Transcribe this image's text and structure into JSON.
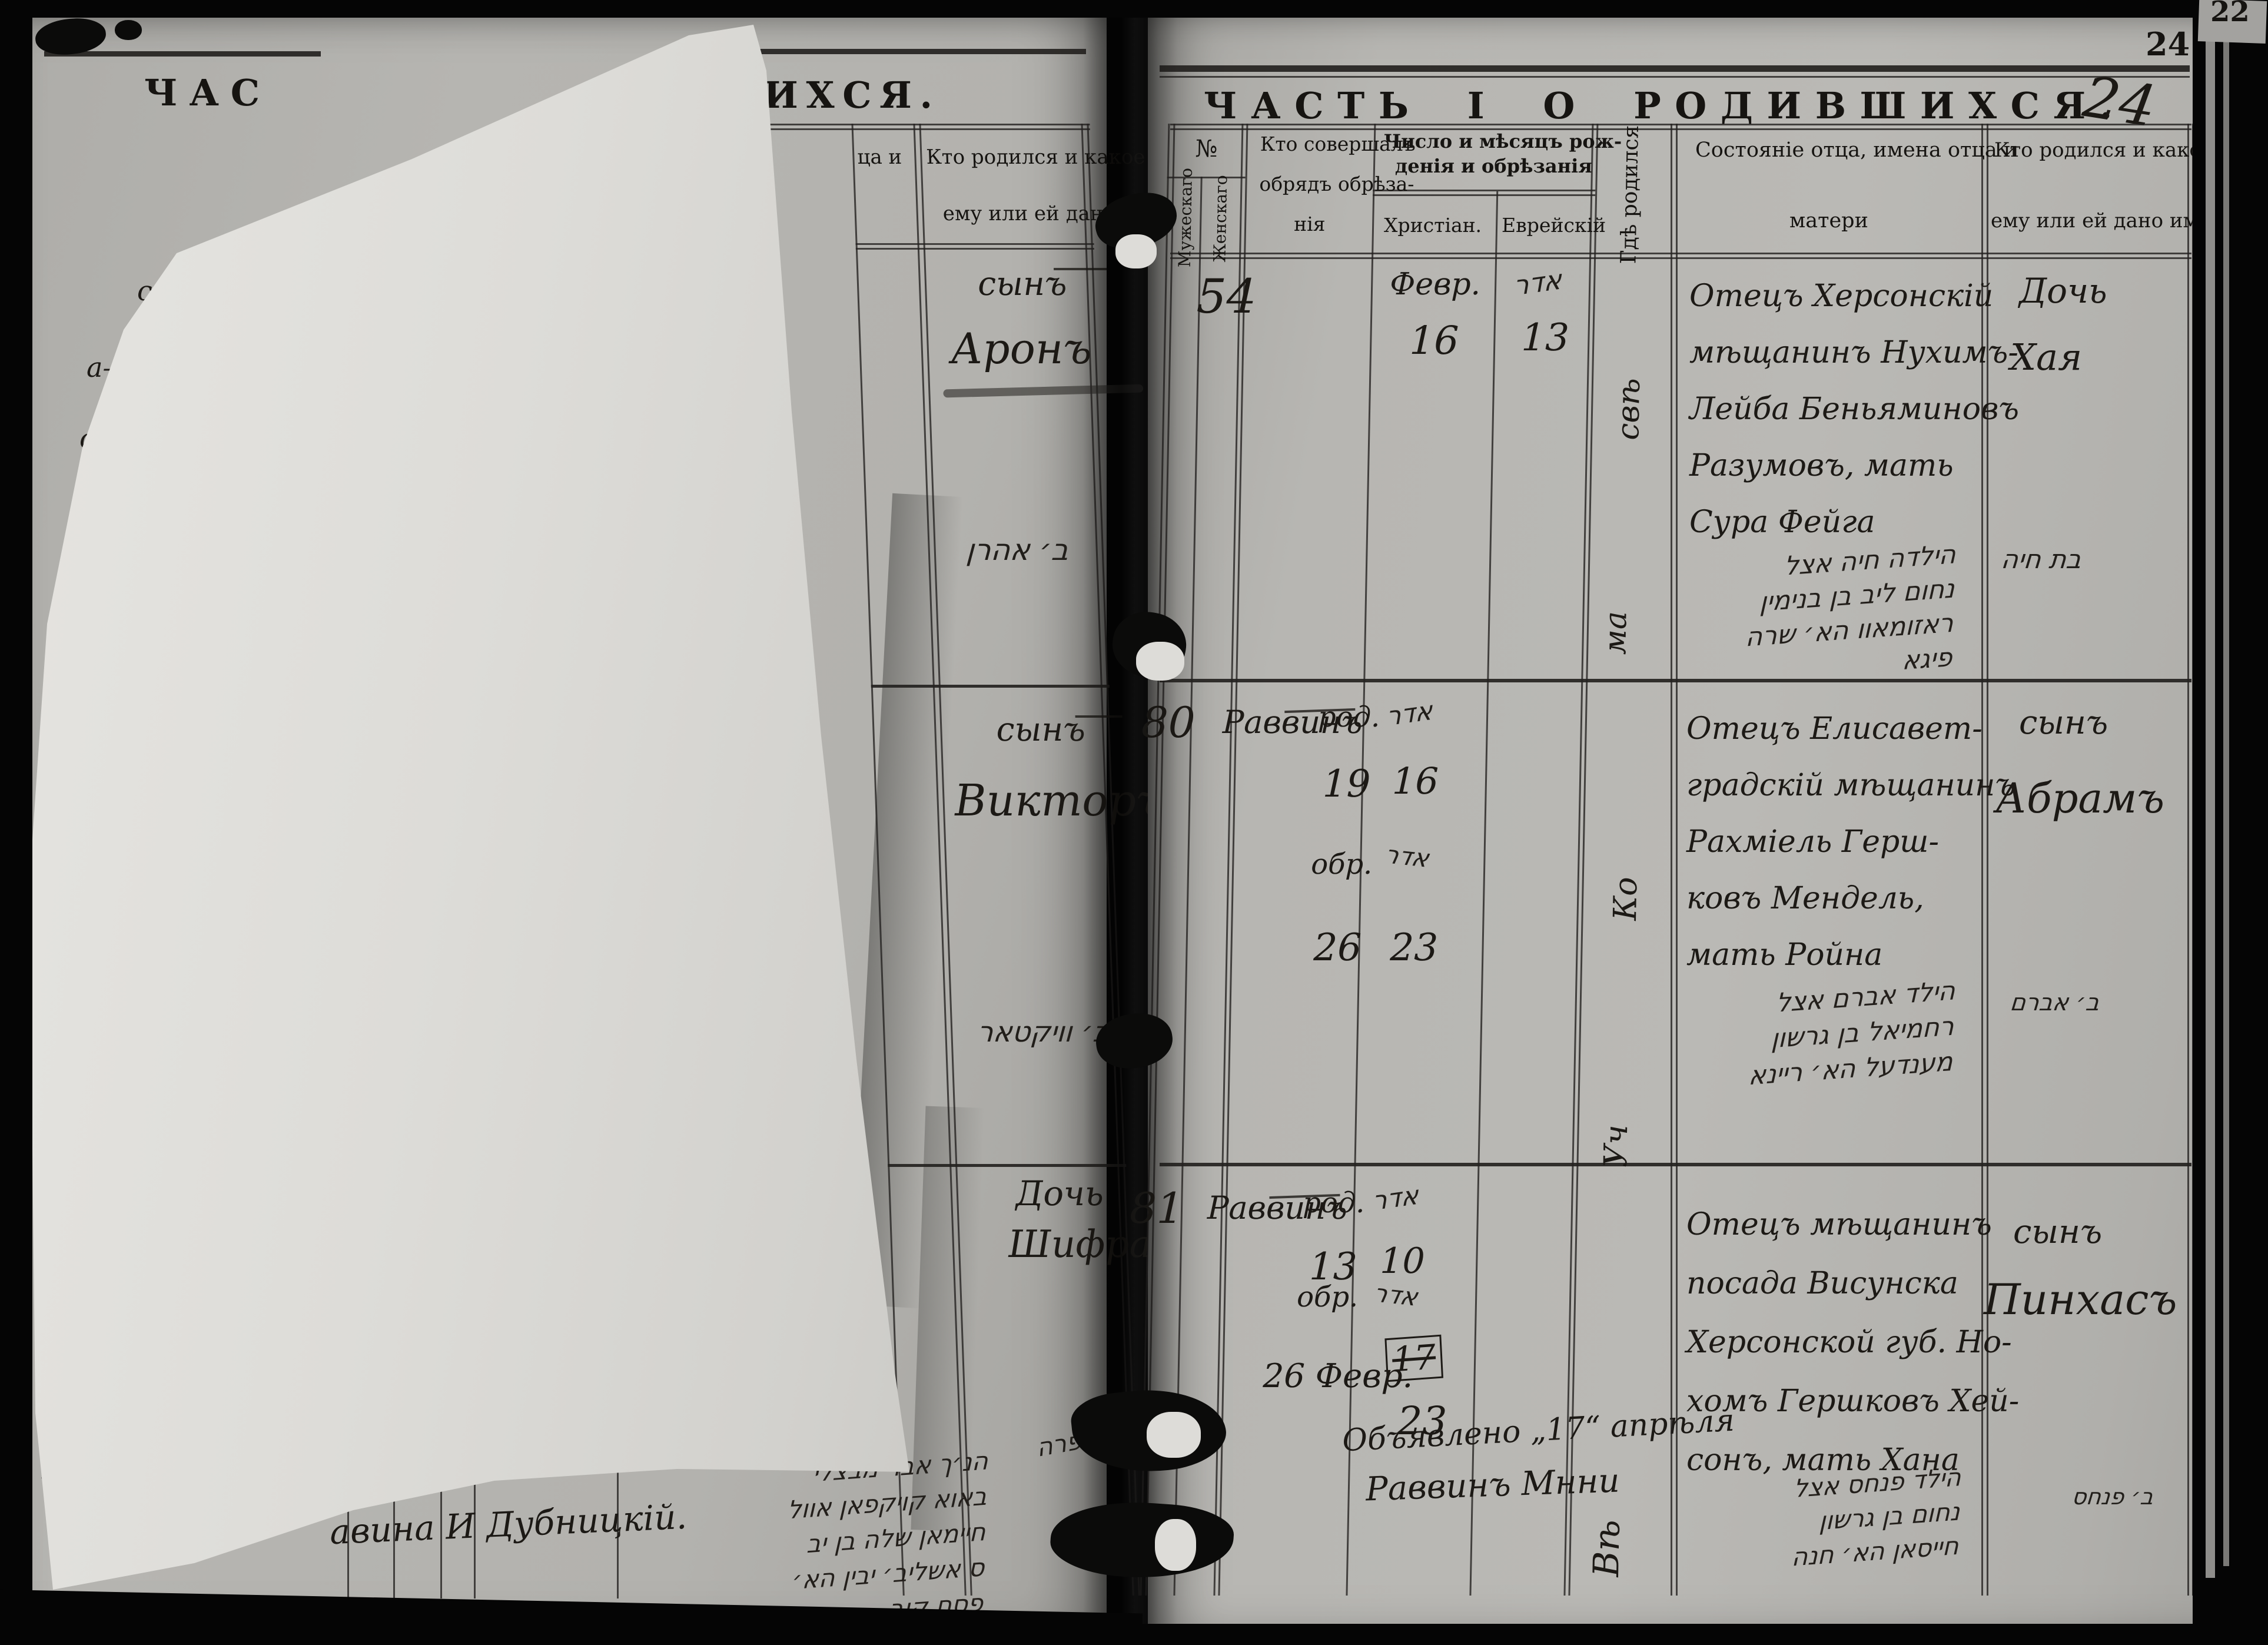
{
  "scan": {
    "corner_fragment": "22",
    "printed_page_number": "24",
    "handwritten_page_number": "24"
  },
  "left_page": {
    "title_fragment_left": "ЧАС",
    "title_fragment_right": "ШИХСЯ.",
    "header": {
      "father_col_fragment": "ца и",
      "name_col_line1": "Кто родился и какое",
      "name_col_line2": "ему или ей дано"
    },
    "margin_fragments": [
      "скій",
      "а—",
      "ой—",
      "на",
      "Ив",
      "мъ",
      "лу"
    ],
    "rows": [
      {
        "relation": "сынъ",
        "name": "Аронъ",
        "hebrew": "ב׳ אהרן"
      },
      {
        "relation": "сынъ",
        "name": "Викторъ",
        "hebrew": "ב׳ וויקטאר"
      },
      {
        "relation": "Дочь",
        "name": "Шифра",
        "hebrew": "בת שפרה"
      }
    ],
    "bottom_note_fragment": "авина И Дубницкій.",
    "bottom_hebrew_lines": [
      "הנ׳ך אבר מבצלי",
      "באוא קויקפאן אוול",
      "חיימאן שלה בן יב",
      "ס אשליב׳ יבין הא׳",
      "פסח קוב"
    ]
  },
  "right_page": {
    "title": "ЧАСТЬ I О РОДИВШИХСЯ.",
    "header": {
      "number_label": "№",
      "number_male": "Мужескаго",
      "number_female": "Женскаго",
      "officiant_line1": "Кто совершалъ",
      "officiant_line2": "обрядъ обрѣза-",
      "officiant_line3": "нія",
      "dates_line1": "Число и мѣсяцъ рож-",
      "dates_line2": "денія и обрѣзанія",
      "dates_sub_christian": "Христіан.",
      "dates_sub_jewish": "Еврейскій",
      "where_born": "Гдѣ родился",
      "father_line1": "Состояніе отца, имена отца и",
      "father_line2": "матери",
      "name_line1": "Кто родился и какое",
      "name_line2": "ему или ей дано имя"
    },
    "entries": [
      {
        "number": "54",
        "christian_month": "Февр.",
        "christian_day": "16",
        "jewish_month": "אדר",
        "jewish_day": "13",
        "where_1": "свѣ",
        "where_2": "ма",
        "father_lines": [
          "Отецъ Херсонскій",
          "мѣщанинъ Нухимъ-",
          "Лейба Беньяминовъ",
          "Разумовъ, мать",
          "Сура Фейга"
        ],
        "hebrew_lines": [
          "הילדה חיה אצל",
          "נחום ליב בן בנימין",
          "ראזומאוו הא׳ שרה",
          "פיגא"
        ],
        "name_rel": "Дочь",
        "name_given": "Хая",
        "name_hebrew": "בת חיה"
      },
      {
        "number": "80",
        "officiant": "Раввинъ",
        "born_label": "род.",
        "born_day": "19",
        "circ_label": "обр.",
        "circ_day": "26",
        "jewish_month": "אדר",
        "jewish_born_day": "16",
        "jewish_month2": "אדר",
        "jewish_circ_day": "23",
        "where_1": "Ко",
        "where_2": "Уч",
        "father_lines": [
          "Отецъ Елисавет-",
          "градскій мѣщанинъ",
          "Рахміель Герш-",
          "ковъ Мендель,",
          "мать Ройна"
        ],
        "hebrew_lines": [
          "הילד אברם אצל",
          "רחמיאל בן גרשון",
          "מענדעל הא׳ ריינא"
        ],
        "name_rel": "сынъ",
        "name_given": "Абрамъ",
        "name_hebrew": "ב׳ אברם"
      },
      {
        "number": "81",
        "officiant": "Раввинъ",
        "born_label": "род.",
        "born_day": "13",
        "circ_label": "обр.",
        "circ_date": "26 Февр.",
        "jewish_month": "אדר",
        "jewish_born_day": "10",
        "jewish_month2": "אדר",
        "struck_day": "17",
        "jewish_circ_day": "23",
        "where_1": "Вѣ",
        "father_lines": [
          "Отецъ мѣщанинъ",
          "посада Висунска",
          "Херсонской губ. Но-",
          "хомъ Гершковъ Хей-",
          "сонъ, мать Хана"
        ],
        "hebrew_lines": [
          "הילד פנחס אצל",
          "נחום בן גרשון",
          "חייסאן הא׳ חנה"
        ],
        "name_rel": "сынъ",
        "name_given": "Пинхасъ",
        "name_hebrew": "ב׳ פנחס",
        "announce_1": "Объявлено „17“ апрѣля",
        "announce_2": "Раввинъ Мнни"
      }
    ]
  }
}
